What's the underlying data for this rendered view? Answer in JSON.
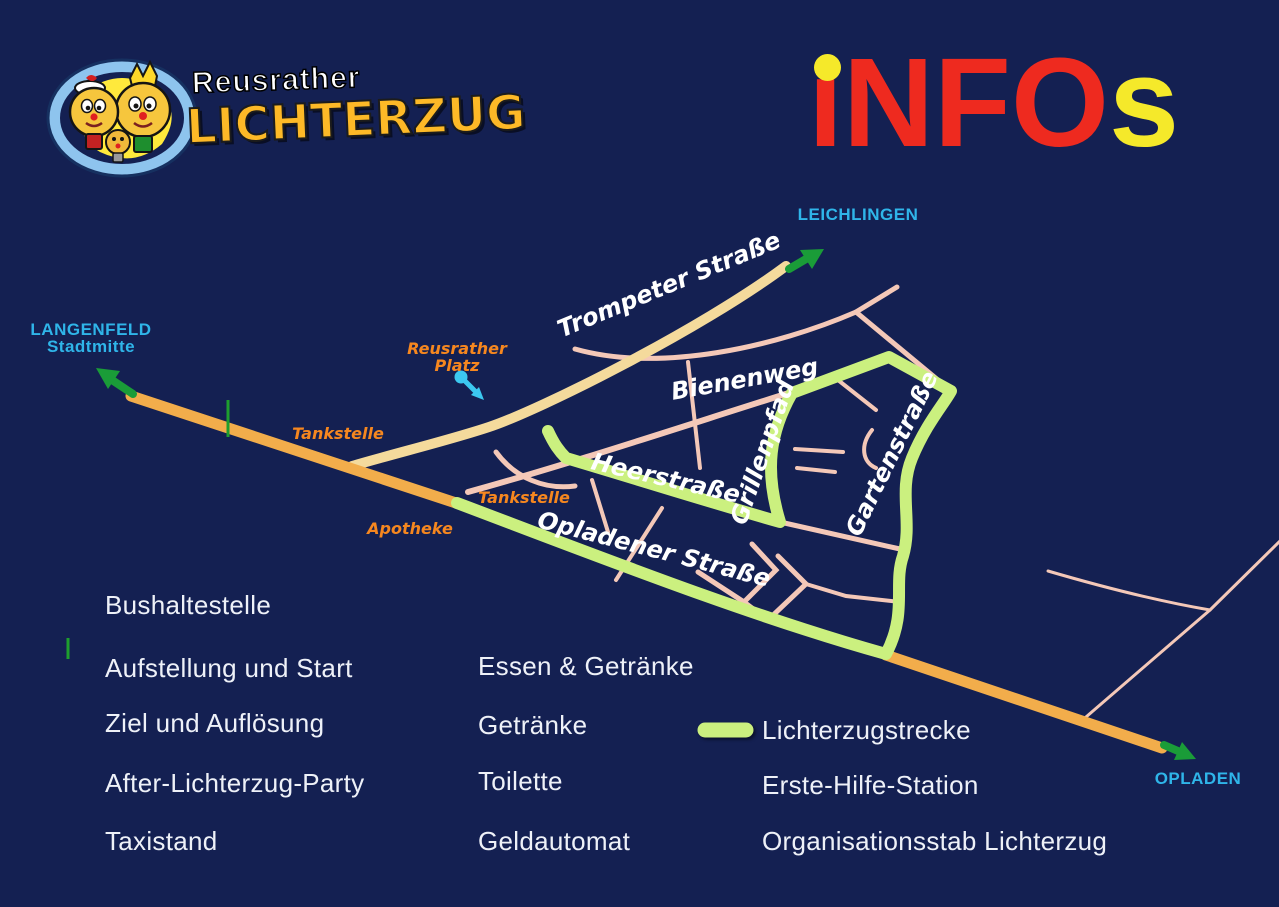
{
  "colors": {
    "background": "#142052",
    "road_orange": "#f2ad4b",
    "road_pale": "#f4da9c",
    "road_pink": "#f4c8b8",
    "route_green": "#cbf07f",
    "arrow_green": "#1a9c38",
    "city_cyan": "#2fb5e9",
    "poi_orange": "#f6871f",
    "title_red": "#ee2a1f",
    "title_yellow": "#f5e92a"
  },
  "logo": {
    "subtitle": "Reusrather",
    "title": "LICHTERZUG"
  },
  "heading": {
    "i": "ı",
    "nfo": "NFO",
    "s": "s",
    "full": "iNFOs"
  },
  "map": {
    "cities": {
      "langenfeld_line1": "LANGENFELD",
      "langenfeld_line2": "Stadtmitte",
      "leichlingen": "LEICHLINGEN",
      "opladen": "OPLADEN"
    },
    "streets": {
      "trompeter": "Trompeter Straße",
      "bienenweg": "Bienenweg",
      "heerstrasse": "Heerstraße",
      "opladener": "Opladener Straße",
      "grillenpfad": "Grillenpfad",
      "gartenstrasse": "Gartenstraße"
    },
    "pois": {
      "tankstelle_nw": "Tankstelle",
      "tankstelle_s": "Tankstelle",
      "apotheke": "Apotheke",
      "platz_line1": "Reusrather",
      "platz_line2": "Platz"
    },
    "labels": {
      "h": "H",
      "busstop_line1": "Grünewald-",
      "busstop_line2": "straße",
      "taxi": "TAXI",
      "s": "S",
      "z": "Z",
      "wc": "WC",
      "ec_e": "e",
      "ec_c": "C",
      "ec_sub": "electronic cash",
      "note": "♫"
    }
  },
  "legend": {
    "col1": [
      {
        "icon": "bus-stop-sign",
        "label": "Bushaltestelle"
      },
      {
        "icon": "start-marker",
        "label": "Aufstellung und Start"
      },
      {
        "icon": "finish-marker",
        "label": "Ziel und Auflösung"
      },
      {
        "icon": "party-marker",
        "label": "After-Lichterzug-Party"
      },
      {
        "icon": "taxi-sign",
        "label": "Taxistand"
      }
    ],
    "col2": [
      {
        "icon": "food-drink-icon",
        "label": "Essen & Getränke"
      },
      {
        "icon": "drink-icon",
        "label": "Getränke"
      },
      {
        "icon": "wc-icon",
        "label": "Toilette"
      },
      {
        "icon": "ec-cash-icon",
        "label": "Geldautomat"
      }
    ],
    "col3": [
      {
        "icon": "route-line",
        "label": "Lichterzugstrecke"
      },
      {
        "icon": "first-aid-icon",
        "label": "Erste-Hilfe-Station"
      },
      {
        "icon": "org-icon",
        "label": "Organisationsstab Lichterzug"
      }
    ]
  }
}
